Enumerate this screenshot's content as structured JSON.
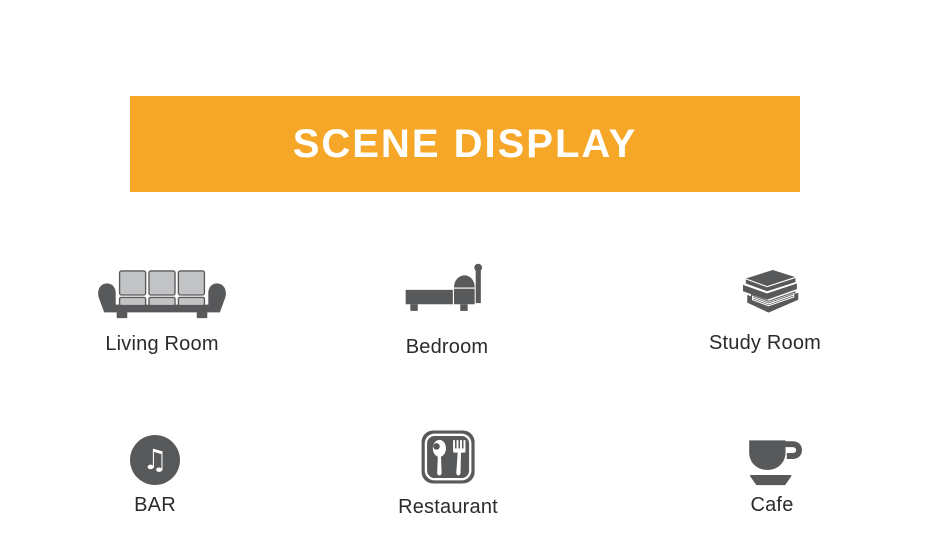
{
  "banner": {
    "title": "SCENE DISPLAY",
    "bg_color": "#F6A728",
    "text_color": "#FFFFFF"
  },
  "scenes": [
    {
      "label": "Living Room",
      "icon": "sofa-icon"
    },
    {
      "label": "Bedroom",
      "icon": "bed-icon"
    },
    {
      "label": "Study Room",
      "icon": "books-icon"
    },
    {
      "label": "BAR",
      "icon": "music-note-icon"
    },
    {
      "label": "Restaurant",
      "icon": "cutlery-icon"
    },
    {
      "label": "Cafe",
      "icon": "coffee-cup-icon"
    }
  ],
  "icons": {
    "bar_note_glyph": "♫"
  },
  "colors": {
    "icon_dark_gray": "#58595B",
    "icon_light_gray": "#C2C3C5",
    "label_color": "#2B2B2B"
  }
}
